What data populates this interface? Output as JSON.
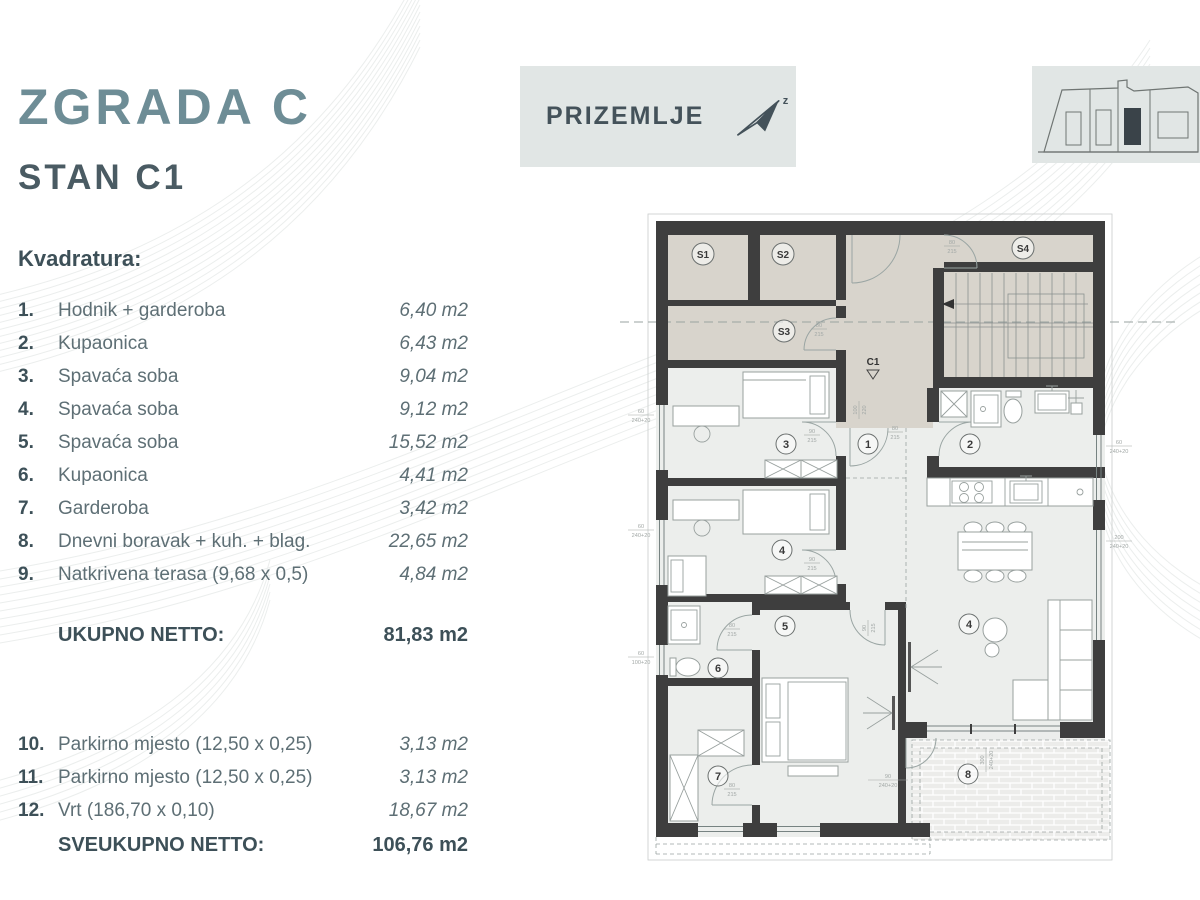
{
  "header": {
    "title": "ZGRADA  C",
    "subtitle": "STAN  C1",
    "section_heading": "Kvadratura:"
  },
  "rooms": [
    {
      "num": "1.",
      "name": "Hodnik + garderoba",
      "area": "6,40 m2"
    },
    {
      "num": "2.",
      "name": "Kupaonica",
      "area": "6,43 m2"
    },
    {
      "num": "3.",
      "name": "Spavaća soba",
      "area": "9,04 m2"
    },
    {
      "num": "4.",
      "name": "Spavaća soba",
      "area": "9,12 m2"
    },
    {
      "num": "5.",
      "name": "Spavaća soba",
      "area": "15,52 m2"
    },
    {
      "num": "6.",
      "name": "Kupaonica",
      "area": "4,41 m2"
    },
    {
      "num": "7.",
      "name": "Garderoba",
      "area": "3,42 m2"
    },
    {
      "num": "8.",
      "name": "Dnevni boravak + kuh. + blag.",
      "area": "22,65 m2"
    },
    {
      "num": "9.",
      "name": "Natkrivena terasa (9,68 x 0,5)",
      "area": "4,84 m2"
    }
  ],
  "totals": {
    "ukupno_label": "UKUPNO NETTO:",
    "ukupno_value": "81,83 m2",
    "sveukupno_label": "SVEUKUPNO NETTO:",
    "sveukupno_value": "106,76 m2"
  },
  "extras": [
    {
      "num": "10.",
      "name": "Parkirno mjesto (12,50 x 0,25)",
      "area": "3,13 m2"
    },
    {
      "num": "11.",
      "name": "Parkirno mjesto (12,50 x 0,25)",
      "area": "3,13 m2"
    },
    {
      "num": "12.",
      "name": "Vrt (186,70 x 0,10)",
      "area": "18,67 m2"
    }
  ],
  "banner": {
    "floor_label": "PRIZEMLJE",
    "north_letter": "z"
  },
  "plan": {
    "storage": {
      "s1": "S1",
      "s2": "S2",
      "s3": "S3",
      "s4": "S4"
    },
    "entry_label": "C1",
    "circles": [
      "3",
      "1",
      "2",
      "4",
      "5",
      "6",
      "7",
      "4",
      "8"
    ],
    "dims": {
      "w80": "80",
      "w90": "90",
      "w100": "100",
      "h215": "215",
      "h220": "220",
      "d60": "60",
      "d90": "90",
      "d200": "200",
      "d300": "300",
      "p240": "240+20",
      "p100": "100+20"
    },
    "colors": {
      "wall": "#3e3e3e",
      "common_fill": "#d8d4cc",
      "room_fill": "#eceeec",
      "accent": "#6e8d96"
    }
  }
}
